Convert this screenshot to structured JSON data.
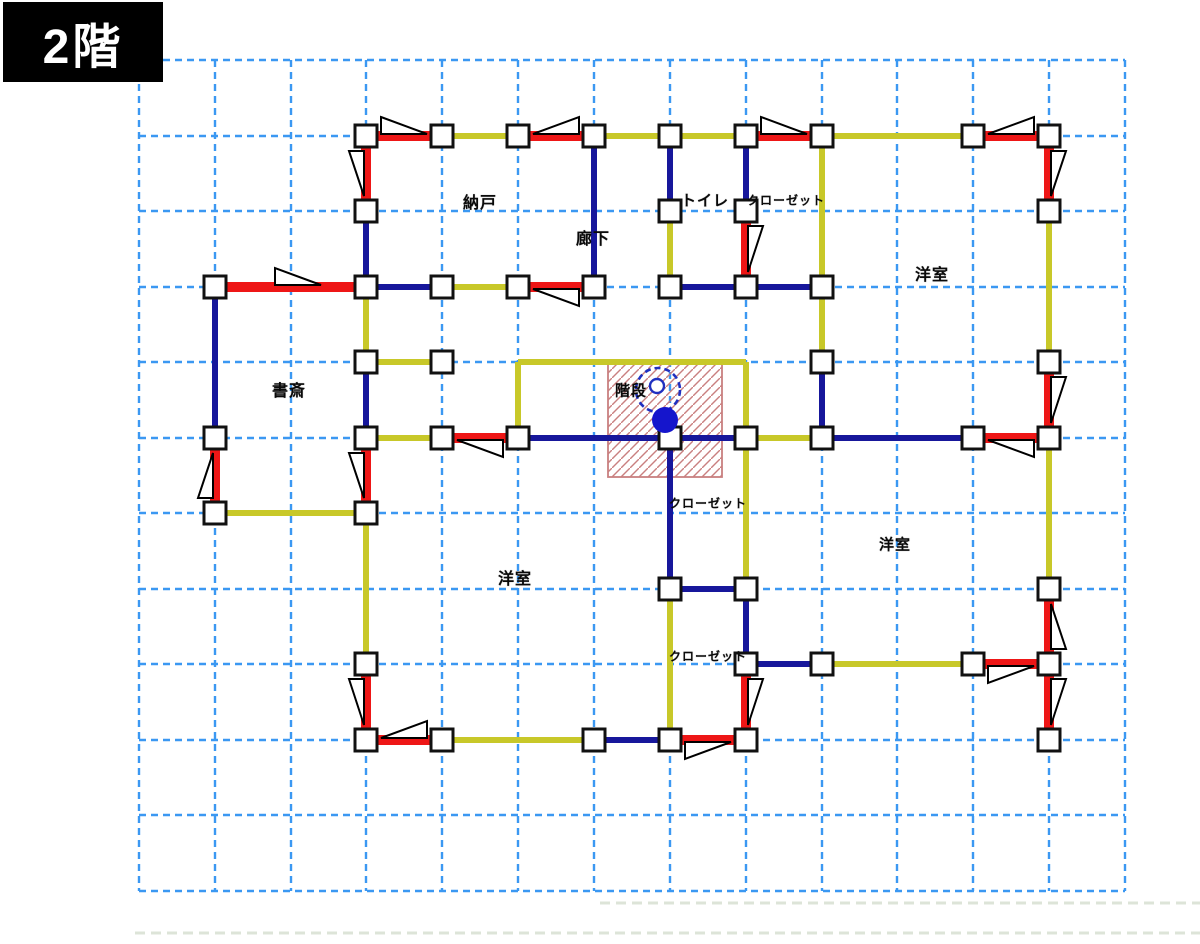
{
  "title": {
    "label": "2階"
  },
  "colors": {
    "grid": "#3b98f2",
    "wall_navy": "#17179b",
    "wall_yellow": "#c8c829",
    "brace_red": "#ee1616",
    "column_fill": "#ffffff",
    "column_stroke": "#111111",
    "triangle_fill": "#ffffff",
    "triangle_stroke": "#000000",
    "hatch": "#c98080",
    "stair_blue": "#2030c0",
    "stair_dot": "#1515cc",
    "baseline": "#dde4d8",
    "title_bg": "#000000",
    "title_fg": "#ffffff"
  },
  "floor_plan": {
    "grid": {
      "cols": [
        139,
        215,
        291,
        366,
        442,
        518,
        594,
        670,
        746,
        822,
        897,
        973,
        1049,
        1125
      ],
      "rows": [
        60,
        136,
        211,
        287,
        362,
        438,
        513,
        589,
        664,
        740,
        815,
        891
      ],
      "top": 60,
      "bottom": 891,
      "left": 139,
      "right": 1125
    },
    "baselines": [
      {
        "x1": 600,
        "y": 903,
        "x2": 1200
      },
      {
        "x1": 135,
        "y": 933,
        "x2": 1200
      }
    ],
    "walls": {
      "yellow": [
        [
          442,
          136,
          518,
          136
        ],
        [
          594,
          136,
          670,
          136
        ],
        [
          670,
          136,
          746,
          136
        ],
        [
          822,
          136,
          973,
          136
        ],
        [
          670,
          211,
          670,
          287
        ],
        [
          822,
          136,
          822,
          287
        ],
        [
          822,
          287,
          822,
          362
        ],
        [
          366,
          287,
          366,
          362
        ],
        [
          442,
          287,
          518,
          287
        ],
        [
          366,
          362,
          442,
          362
        ],
        [
          1049,
          211,
          1049,
          362
        ],
        [
          215,
          513,
          366,
          513
        ],
        [
          366,
          438,
          442,
          438
        ],
        [
          518,
          362,
          518,
          438
        ],
        [
          518,
          362,
          746,
          362
        ],
        [
          746,
          362,
          746,
          438
        ],
        [
          746,
          438,
          746,
          589
        ],
        [
          746,
          438,
          822,
          438
        ],
        [
          1049,
          438,
          1049,
          589
        ],
        [
          366,
          513,
          366,
          664
        ],
        [
          670,
          589,
          670,
          740
        ],
        [
          442,
          740,
          594,
          740
        ],
        [
          822,
          664,
          973,
          664
        ]
      ],
      "navy": [
        [
          594,
          136,
          594,
          287
        ],
        [
          366,
          211,
          366,
          287
        ],
        [
          670,
          136,
          670,
          211
        ],
        [
          746,
          136,
          746,
          211
        ],
        [
          215,
          287,
          215,
          438
        ],
        [
          366,
          287,
          442,
          287
        ],
        [
          670,
          287,
          746,
          287
        ],
        [
          746,
          287,
          822,
          287
        ],
        [
          366,
          362,
          366,
          438
        ],
        [
          518,
          438,
          670,
          438
        ],
        [
          670,
          438,
          746,
          438
        ],
        [
          822,
          438,
          973,
          438
        ],
        [
          822,
          362,
          822,
          438
        ],
        [
          670,
          438,
          670,
          589
        ],
        [
          670,
          589,
          746,
          589
        ],
        [
          746,
          589,
          746,
          664
        ],
        [
          746,
          664,
          822,
          664
        ],
        [
          594,
          740,
          670,
          740
        ]
      ]
    },
    "braces": [
      {
        "x1": 366,
        "y1": 136,
        "x2": 442,
        "y2": 136,
        "side": "above",
        "leg": "left"
      },
      {
        "x1": 518,
        "y1": 136,
        "x2": 594,
        "y2": 136,
        "side": "above",
        "leg": "right"
      },
      {
        "x1": 746,
        "y1": 136,
        "x2": 822,
        "y2": 136,
        "side": "above",
        "leg": "left"
      },
      {
        "x1": 973,
        "y1": 136,
        "x2": 1049,
        "y2": 136,
        "side": "above",
        "leg": "right"
      },
      {
        "x1": 366,
        "y1": 136,
        "x2": 366,
        "y2": 211,
        "side": "left",
        "leg": "top"
      },
      {
        "x1": 746,
        "y1": 211,
        "x2": 746,
        "y2": 287,
        "side": "right",
        "leg": "top"
      },
      {
        "x1": 1049,
        "y1": 136,
        "x2": 1049,
        "y2": 211,
        "side": "right",
        "leg": "top"
      },
      {
        "x1": 215,
        "y1": 287,
        "x2": 366,
        "y2": 287,
        "side": "above",
        "leg": "left",
        "toff": 45
      },
      {
        "x1": 518,
        "y1": 287,
        "x2": 594,
        "y2": 287,
        "side": "below",
        "leg": "right"
      },
      {
        "x1": 215,
        "y1": 438,
        "x2": 215,
        "y2": 513,
        "side": "left",
        "leg": "bottom"
      },
      {
        "x1": 366,
        "y1": 438,
        "x2": 366,
        "y2": 513,
        "side": "left",
        "leg": "top"
      },
      {
        "x1": 442,
        "y1": 438,
        "x2": 518,
        "y2": 438,
        "side": "below",
        "leg": "right"
      },
      {
        "x1": 973,
        "y1": 438,
        "x2": 1049,
        "y2": 438,
        "side": "below",
        "leg": "right"
      },
      {
        "x1": 366,
        "y1": 664,
        "x2": 366,
        "y2": 740,
        "side": "left",
        "leg": "top"
      },
      {
        "x1": 366,
        "y1": 740,
        "x2": 442,
        "y2": 740,
        "side": "above",
        "leg": "right"
      },
      {
        "x1": 670,
        "y1": 740,
        "x2": 746,
        "y2": 740,
        "side": "below",
        "leg": "left"
      },
      {
        "x1": 746,
        "y1": 664,
        "x2": 746,
        "y2": 740,
        "side": "right",
        "leg": "top"
      },
      {
        "x1": 973,
        "y1": 664,
        "x2": 1049,
        "y2": 664,
        "side": "below",
        "leg": "left"
      },
      {
        "x1": 1049,
        "y1": 362,
        "x2": 1049,
        "y2": 438,
        "side": "right",
        "leg": "top"
      },
      {
        "x1": 1049,
        "y1": 589,
        "x2": 1049,
        "y2": 664,
        "side": "right",
        "leg": "bottom"
      },
      {
        "x1": 1049,
        "y1": 664,
        "x2": 1049,
        "y2": 740,
        "side": "right",
        "leg": "top"
      }
    ],
    "columns": [
      [
        366,
        136
      ],
      [
        442,
        136
      ],
      [
        518,
        136
      ],
      [
        594,
        136
      ],
      [
        670,
        136
      ],
      [
        746,
        136
      ],
      [
        822,
        136
      ],
      [
        973,
        136
      ],
      [
        1049,
        136
      ],
      [
        366,
        211
      ],
      [
        670,
        211
      ],
      [
        746,
        211
      ],
      [
        1049,
        211
      ],
      [
        215,
        287
      ],
      [
        366,
        287
      ],
      [
        442,
        287
      ],
      [
        518,
        287
      ],
      [
        594,
        287
      ],
      [
        670,
        287
      ],
      [
        746,
        287
      ],
      [
        822,
        287
      ],
      [
        366,
        362
      ],
      [
        442,
        362
      ],
      [
        822,
        362
      ],
      [
        1049,
        362
      ],
      [
        215,
        438
      ],
      [
        366,
        438
      ],
      [
        442,
        438
      ],
      [
        518,
        438
      ],
      [
        670,
        438
      ],
      [
        746,
        438
      ],
      [
        822,
        438
      ],
      [
        973,
        438
      ],
      [
        1049,
        438
      ],
      [
        215,
        513
      ],
      [
        366,
        513
      ],
      [
        670,
        589
      ],
      [
        746,
        589
      ],
      [
        1049,
        589
      ],
      [
        366,
        664
      ],
      [
        746,
        664
      ],
      [
        822,
        664
      ],
      [
        973,
        664
      ],
      [
        1049,
        664
      ],
      [
        366,
        740
      ],
      [
        442,
        740
      ],
      [
        594,
        740
      ],
      [
        670,
        740
      ],
      [
        746,
        740
      ],
      [
        1049,
        740
      ]
    ],
    "stairs": {
      "x": 608,
      "y": 363,
      "w": 114,
      "h": 114,
      "dashed_circle": {
        "cx": 658,
        "cy": 390,
        "r": 22
      },
      "small_circle": {
        "cx": 657,
        "cy": 386,
        "r": 7
      },
      "dot": {
        "cx": 665,
        "cy": 420,
        "r": 13
      }
    },
    "rooms": [
      {
        "id": "nando",
        "label": "納戸",
        "x": 480,
        "y": 201,
        "size": 16
      },
      {
        "id": "rouka",
        "label": "廊下",
        "x": 593,
        "y": 237,
        "size": 16
      },
      {
        "id": "toilet",
        "label": "トイレ",
        "x": 705,
        "y": 200,
        "size": 15
      },
      {
        "id": "closet-top",
        "label": "クローゼット",
        "x": 786,
        "y": 200,
        "size": 12
      },
      {
        "id": "youshitsu-top-right",
        "label": "洋室",
        "x": 932,
        "y": 273,
        "size": 16
      },
      {
        "id": "shosai",
        "label": "書斎",
        "x": 289,
        "y": 389,
        "size": 16
      },
      {
        "id": "kaidan",
        "label": "階段",
        "x": 631,
        "y": 390,
        "size": 15
      },
      {
        "id": "closet-mid",
        "label": "クローゼット",
        "x": 708,
        "y": 503,
        "size": 12
      },
      {
        "id": "youshitsu-bottom-left",
        "label": "洋室",
        "x": 515,
        "y": 577,
        "size": 16
      },
      {
        "id": "closet-bottom",
        "label": "クローゼット",
        "x": 708,
        "y": 656,
        "size": 12
      },
      {
        "id": "youshitsu-bottom-right",
        "label": "洋室",
        "x": 895,
        "y": 544,
        "size": 15
      }
    ]
  }
}
